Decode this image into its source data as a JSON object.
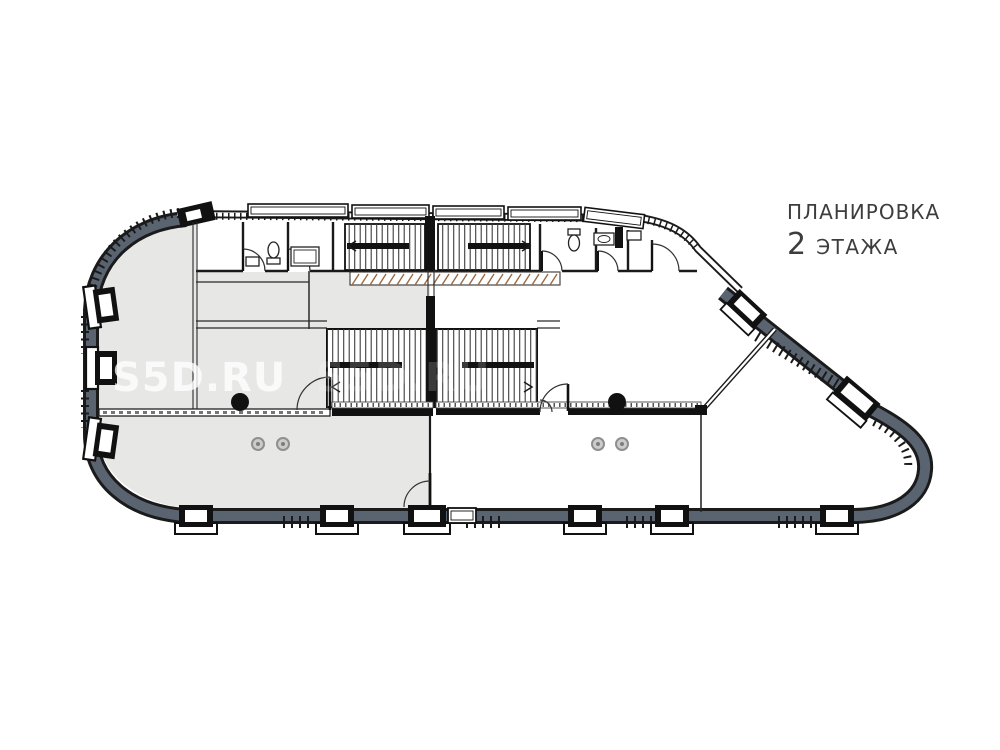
{
  "title": {
    "line1": "ПЛАНИРОВКА",
    "floor_number": "2",
    "line2_text": "ЭТАЖА"
  },
  "watermark": {
    "text": "S5D.RU"
  },
  "colors": {
    "paper": "#ffffff",
    "wall": "#5a6470",
    "outline": "#1b1b1b",
    "floorShaded": "#e7e7e6",
    "titleColor": "#3d3d3d",
    "watermarkColor": "rgba(255,255,255,0.78)"
  },
  "plan": {
    "drawing_type": "floor-plan",
    "floor_title_combined": "ПЛАНИРОВКА 2 ЭТАЖА"
  }
}
